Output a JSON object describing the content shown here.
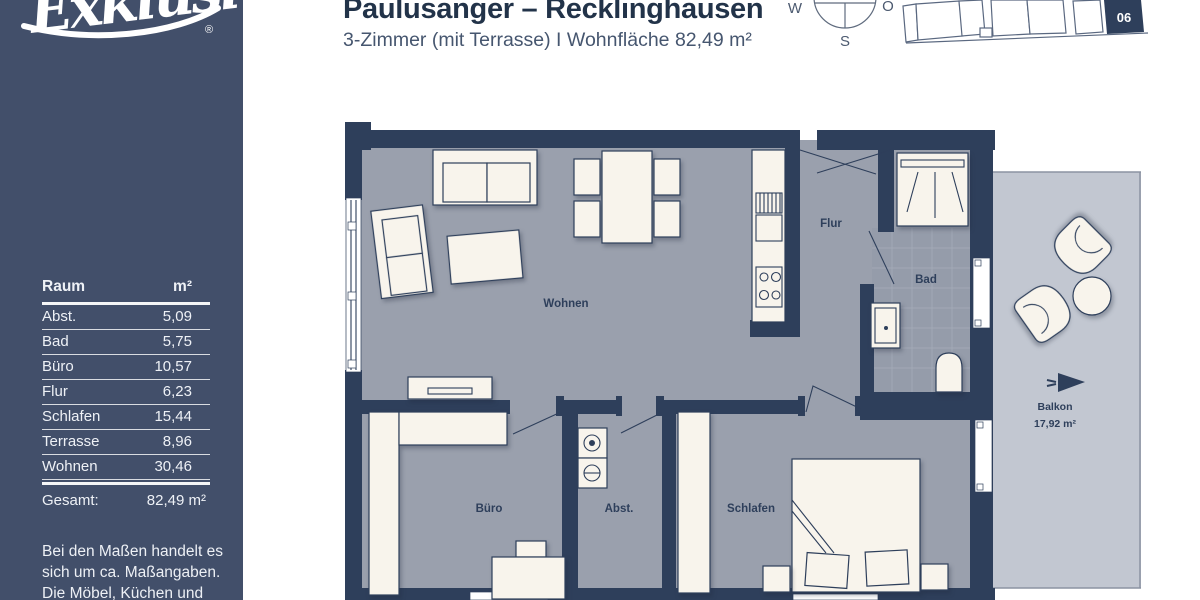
{
  "colors": {
    "sidebar_bg": "#424f6a",
    "wall_navy": "#2e3f5b",
    "floor_gray": "#9aa0ad",
    "balcony_gray": "#c2c7d1",
    "furniture_cream": "#f8f4ec",
    "title_navy": "#223349"
  },
  "logo": {
    "text": "Exklusiv",
    "registered": "®"
  },
  "header": {
    "title": "Paulusanger – Recklinghausen",
    "subtitle": "3-Zimmer (mit Terrasse) I Wohnfläche 82,49 m²"
  },
  "compass": {
    "west": "W",
    "east": "O",
    "south": "S"
  },
  "keyplan": {
    "highlighted_unit": "06"
  },
  "room_table": {
    "col_room": "Raum",
    "col_area": "m²",
    "rows": [
      {
        "room": "Abst.",
        "area": "5,09"
      },
      {
        "room": "Bad",
        "area": "5,75"
      },
      {
        "room": "Büro",
        "area": "10,57"
      },
      {
        "room": "Flur",
        "area": "6,23"
      },
      {
        "room": "Schlafen",
        "area": "15,44"
      },
      {
        "room": "Terrasse",
        "area": "8,96"
      },
      {
        "room": "Wohnen",
        "area": "30,46"
      }
    ],
    "total_label": "Gesamt:",
    "total_value": "82,49 m²"
  },
  "disclaimer": {
    "line1": "Bei den Maßen handelt es",
    "line2": "sich um ca. Maßangaben.",
    "line3": "Die Möbel, Küchen und",
    "line4": "Sanitärobjekte sind"
  },
  "floorplan": {
    "labels": {
      "wohnen": "Wohnen",
      "flur": "Flur",
      "bad": "Bad",
      "buero": "Büro",
      "abst": "Abst.",
      "schlafen": "Schlafen",
      "balkon": "Balkon",
      "balkon_area": "17,92 m²"
    }
  }
}
